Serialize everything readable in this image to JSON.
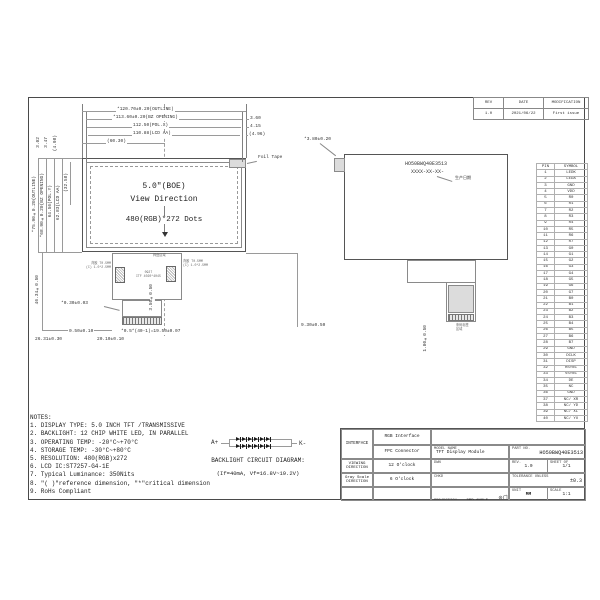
{
  "revision_table": {
    "headers": [
      "REV",
      "DATE",
      "MODIFICATION"
    ],
    "rows": [
      [
        "1.0",
        "2021/06/22",
        "First issue"
      ]
    ]
  },
  "front_view": {
    "size_label": "5.0\"(BOE)",
    "view_direction": "View Direction",
    "resolution": "480(RGB)*272 Dots",
    "foil_tape_label": "Foil Tape",
    "pad_area_label": "焊盘区域",
    "left_pad_note1": "背胶 T0.5MM",
    "left_pad_note2": "(C) 1.0*2.5MM",
    "right_pad_note1": "背胶 T0.5MM",
    "right_pad_note2": "(C) 1.0*2.5MM",
    "center_note1": "0927",
    "center_note2": "ITF 4020*4045"
  },
  "back_view": {
    "part_no": "HO50BWQ40E3513",
    "date_code": "XXXX-XX-XX-",
    "date_label": "生产日期",
    "label_note1": "条码标签",
    "label_note2": "区域"
  },
  "dims": {
    "top1": "*120.70±0.20(OUTLINE)",
    "top2": "*113.60±0.20(BZ OPENING)",
    "top3": "112.50(POL.X)",
    "top4": "110.88(LCD AA)",
    "top5": "(60.30)",
    "right1": "3.60",
    "right2": "4.15",
    "right3": "(4.96)",
    "left1": "*75.90±0.20(OUTLINE)",
    "left2": "*68.90±0.20(BZ OPENING)",
    "left3": "64.56(POL.Y)",
    "left4": "62.83(LCD AA)",
    "left5": "(32.58)",
    "topleft1": "3.02",
    "topleft2": "3.47",
    "topleft3": "(4.98)",
    "fpc_len": "46.34±0.50",
    "fpc_th": "*0.30±0.03",
    "stiff": "0.50±0.10",
    "off1": "26.31±0.30",
    "off2": "20.10±0.10",
    "pitch": "*0.5*(40-1)=19.50±0.07",
    "tail_h": "3.50±0.50",
    "gap": "9.30±0.50",
    "tab": "*3.80±0.20",
    "label_h": "1.00±0.50"
  },
  "pin_table": {
    "headers": [
      "PIN",
      "SYMBOL"
    ],
    "rows": [
      [
        "1",
        "LEDK"
      ],
      [
        "2",
        "LEDA"
      ],
      [
        "3",
        "GND"
      ],
      [
        "4",
        "VDD"
      ],
      [
        "5",
        "R0"
      ],
      [
        "6",
        "R1"
      ],
      [
        "7",
        "R2"
      ],
      [
        "8",
        "R3"
      ],
      [
        "9",
        "R4"
      ],
      [
        "10",
        "R5"
      ],
      [
        "11",
        "R6"
      ],
      [
        "12",
        "R7"
      ],
      [
        "13",
        "G0"
      ],
      [
        "14",
        "G1"
      ],
      [
        "15",
        "G2"
      ],
      [
        "16",
        "G3"
      ],
      [
        "17",
        "G4"
      ],
      [
        "18",
        "G5"
      ],
      [
        "19",
        "G6"
      ],
      [
        "20",
        "G7"
      ],
      [
        "21",
        "B0"
      ],
      [
        "22",
        "B1"
      ],
      [
        "23",
        "B2"
      ],
      [
        "24",
        "B3"
      ],
      [
        "25",
        "B4"
      ],
      [
        "26",
        "B5"
      ],
      [
        "27",
        "B6"
      ],
      [
        "28",
        "B7"
      ],
      [
        "29",
        "GND"
      ],
      [
        "30",
        "DCLK"
      ],
      [
        "31",
        "DISP"
      ],
      [
        "32",
        "HSYNC"
      ],
      [
        "33",
        "VSYNC"
      ],
      [
        "34",
        "DE"
      ],
      [
        "35",
        "NC"
      ],
      [
        "36",
        "GND"
      ],
      [
        "37",
        "NC/ XR"
      ],
      [
        "38",
        "NC/ YD"
      ],
      [
        "39",
        "NC/ XL"
      ],
      [
        "40",
        "NC/ YU"
      ]
    ]
  },
  "notes": {
    "title": "NOTES:",
    "items": [
      "1. DISPLAY TYPE: 5.0 INCH TFT /TRANSMISSIVE",
      "2. BACKLIGHT: 12 CHIP WHITE LED, IN PARALLEL",
      "3. OPERATING TEMP: -20°C~+70°C",
      "4. STORAGE TEMP: -30°C~+80°C",
      "5. RESOLUTION: 480(RGB)x272",
      "6. LCD IC:ST7257-G4-1E",
      "7. Typical Luminance: 350Nits",
      "8. \"( )\"reference dimension, \"*\"critical dimension",
      "9. RoHs Compliant"
    ]
  },
  "backlight": {
    "anode": "A+",
    "cathode": "K-",
    "title": "BACKLIGHT CIRCUIT DIAGRAM:",
    "spec": "(If=40mA, Vf=16.8V~19.2V)",
    "rows": 2,
    "leds_per_row": 6
  },
  "title_block": {
    "interface_label": "INTERFACE",
    "interface_value1": "RGB Interface",
    "interface_value2": "FPC Connector",
    "viewing_label1": "VIEWING",
    "viewing_label2": "DIRECTION",
    "viewing_value": "12 O'clock",
    "gray_label1": "Gray Scale",
    "gray_label2": "DIRECTION",
    "gray_value": "6 O'clock",
    "model_label": "MODEL NAME",
    "model_value": "TFT Display Module",
    "part_label": "PART NO.",
    "part_value": "HO50BWQ40E3513",
    "dwn_label": "DWN",
    "chkd_label": "CHKD",
    "rev_label": "REV.",
    "rev_value": "1.0",
    "sheet_label": "SHEET OF",
    "sheet_value": "1/1",
    "tol_label1": "TOLERANCE UNLESS",
    "tol_label2": "SPECIFIED",
    "tol_value": "±0.3",
    "projection_label": "PROJECTION",
    "projection_value": "3RD ANGLE",
    "unit_label": "UNIT",
    "unit_value": "MM",
    "scale_label": "SCALE",
    "scale_value": "1:1"
  }
}
